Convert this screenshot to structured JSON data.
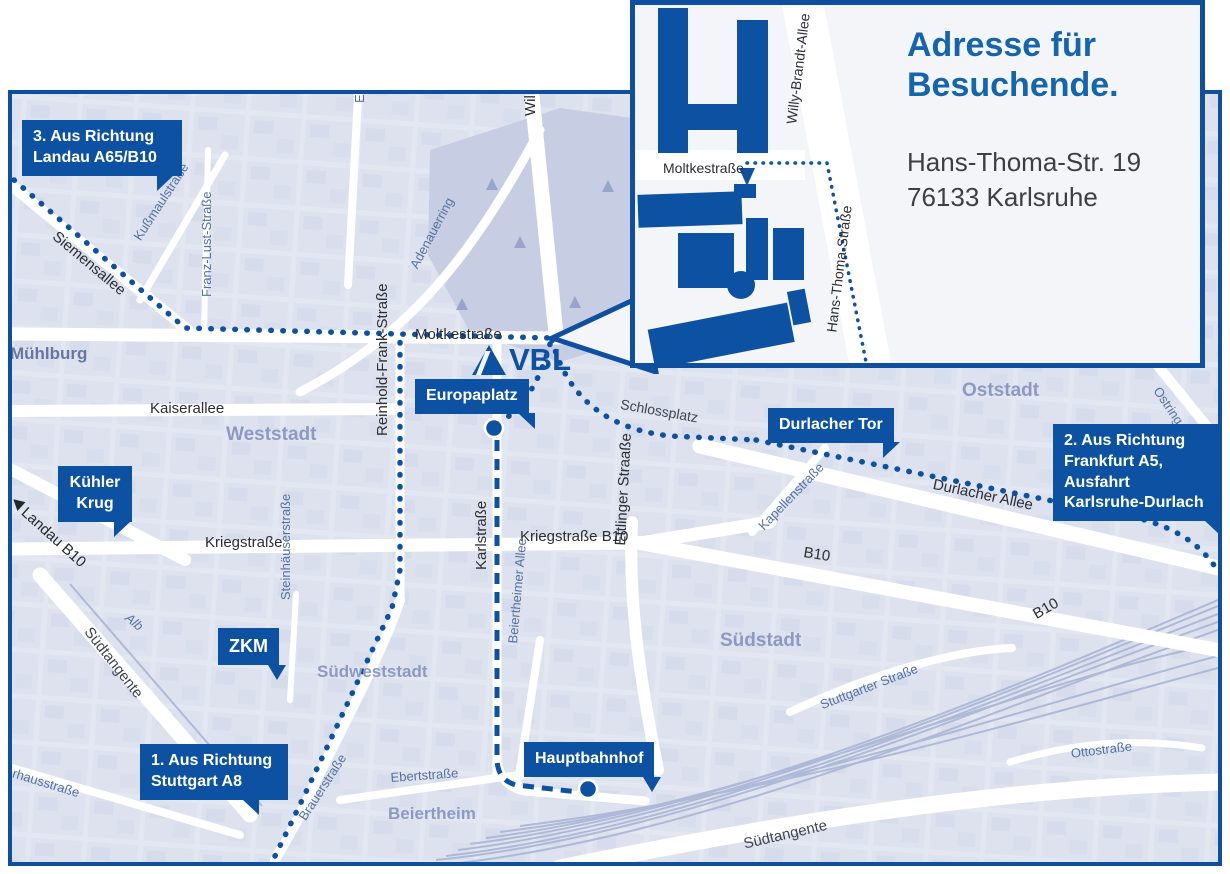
{
  "colors": {
    "brand_blue": "#0d52a2",
    "border_blue": "#0e4f9f",
    "title_blue": "#1464ae",
    "map_bg": "#e1e6f1",
    "block": "#d7ddec",
    "park": "#c7cee3",
    "rail": "#a9b5d5",
    "street_dark": "#2b2d33",
    "street_minor": "#54719f",
    "district": "#8d99c2",
    "white": "#ffffff"
  },
  "logo": {
    "text": "VBL"
  },
  "inset": {
    "title_line1": "Adresse für",
    "title_line2": "Besuchende.",
    "address_line1": "Hans-Thoma-Str. 19",
    "address_line2": "76133 Karlsruhe",
    "streets": {
      "moltkestrasse": "Moltkestraße",
      "willy_brandt_allee": "Willy-Brandt-Allee",
      "hans_thoma_strasse": "Hans-Thoma-Straße"
    }
  },
  "callouts": {
    "landau": {
      "line1": "3. Aus Richtung",
      "line2": "Landau A65/B10"
    },
    "kuehler_krug": {
      "line1": "Kühler",
      "line2": "Krug"
    },
    "zkm": {
      "label": "ZKM"
    },
    "europaplatz": {
      "label": "Europaplatz"
    },
    "durlacher_tor": {
      "label": "Durlacher Tor"
    },
    "frankfurt": {
      "line1": "2. Aus Richtung",
      "line2": "Frankfurt A5,",
      "line3": "Ausfahrt",
      "line4": "Karlsruhe-Durlach"
    },
    "stuttgart": {
      "line1": "1. Aus Richtung",
      "line2": "Stuttgart A8"
    },
    "hauptbahnhof": {
      "label": "Hauptbahnhof"
    }
  },
  "streets": {
    "moltkestrasse": "Moltkestraße",
    "kaiserallee": "Kaiserallee",
    "kriegstrasse": "Kriegstraße",
    "kriegstrasse_b10": "Kriegstraße B10",
    "durlacher_allee": "Durlacher Allee",
    "b10_a": "B10",
    "b10_b": "B10",
    "siemensallee": "Siemensallee",
    "kussmaulstrasse": "Kußmaulstraße",
    "franz_lust_strasse": "Franz-Lust-Straße",
    "erzbergerstrasse": "Erzbergerstraße",
    "adenauerring": "Adenauerring",
    "willy_brandt_allee": "Willy-Brandt-Allee",
    "reinhold_frank_strasse": "Reinhold-Frank-Straße",
    "karlstrasse": "Karlstraße",
    "ettlinger_strasse": "Ettlinger Straaße",
    "schlossplatz": "Schlossplatz",
    "kapellenstrasse": "Kapellenstraße",
    "ostring": "Ostring",
    "landau_b10": "Landau B10",
    "suedtangente_a": "Südtangente",
    "suedtangente_b": "Südtangente",
    "alb": "Alb",
    "steinhaeuserstrasse": "Steinhäuserstraße",
    "brauerstrasse": "Brauerstraße",
    "ebertstrasse": "Ebertstraße",
    "beiertheimer_allee": "Beiertheimer Allee",
    "stuttgarter_strasse": "Stuttgarter Straße",
    "ottostrasse": "Ottostraße",
    "pulverhausstrasse": "Pulverhausstraße"
  },
  "districts": {
    "muehlburg": "Mühlburg",
    "weststadt": "Weststadt",
    "oststadt": "Oststadt",
    "suedstadt": "Südstadt",
    "suedweststadt": "Südweststadt",
    "beiertheim": "Beiertheim"
  }
}
